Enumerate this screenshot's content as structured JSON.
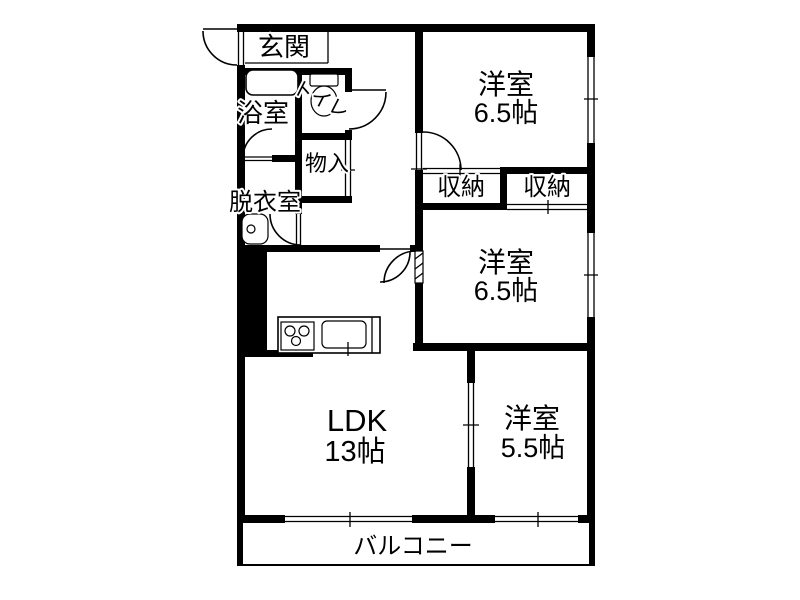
{
  "page": {
    "type": "apartment-floor-plan",
    "background_color": "#ffffff",
    "line_color": "#000000"
  },
  "floor_plan": {
    "rooms": {
      "genkan": {
        "name": "玄関"
      },
      "bathroom": {
        "name": "浴室"
      },
      "toilet": {
        "name": "トイレ"
      },
      "storage": {
        "name": "物入"
      },
      "dressing_room": {
        "name": "脱衣室"
      },
      "closet_left": {
        "name": "収納"
      },
      "closet_right": {
        "name": "収納"
      },
      "western_room_top": {
        "name": "洋室",
        "size": "6.5帖"
      },
      "western_room_mid": {
        "name": "洋室",
        "size": "6.5帖"
      },
      "western_room_small": {
        "name": "洋室",
        "size": "5.5帖"
      },
      "ldk": {
        "name": "LDK",
        "size": "13帖"
      },
      "balcony": {
        "name": "バルコニー"
      }
    },
    "fixtures": [
      "bathtub",
      "toilet-bowl",
      "washbasin",
      "kitchen-stove",
      "kitchen-sink"
    ]
  }
}
